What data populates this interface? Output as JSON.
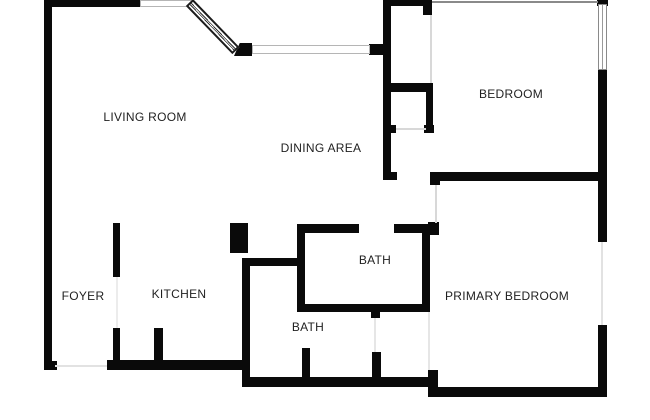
{
  "plan": {
    "width": 650,
    "height": 420,
    "background_color": "#ffffff",
    "wall_color": "#0a0a0a",
    "faint_line_color": "#d8d8d8",
    "window_line_color": "#8a8a8a",
    "label_color": "#1f1f1f"
  },
  "rooms": [
    {
      "id": "living-room",
      "label": "LIVING ROOM",
      "cx": 145,
      "cy": 117
    },
    {
      "id": "dining-area",
      "label": "DINING AREA",
      "cx": 321,
      "cy": 148
    },
    {
      "id": "bedroom",
      "label": "BEDROOM",
      "cx": 511,
      "cy": 94
    },
    {
      "id": "foyer",
      "label": "FOYER",
      "cx": 83,
      "cy": 296
    },
    {
      "id": "kitchen",
      "label": "KITCHEN",
      "cx": 179,
      "cy": 294
    },
    {
      "id": "bath-upper",
      "label": "BATH",
      "cx": 375,
      "cy": 260
    },
    {
      "id": "bath-lower",
      "label": "BATH",
      "cx": 308,
      "cy": 327
    },
    {
      "id": "primary-bedroom",
      "label": "PRIMARY BEDROOM",
      "cx": 507,
      "cy": 296
    }
  ],
  "walls": [
    {
      "name": "left-wall",
      "x": 44,
      "y": 0,
      "w": 8,
      "h": 370
    },
    {
      "name": "left-wall-foot",
      "x": 52,
      "y": 361,
      "w": 5,
      "h": 9
    },
    {
      "name": "top-wall-living",
      "x": 44,
      "y": 0,
      "w": 97,
      "h": 7
    },
    {
      "name": "window-corner-cap",
      "x": 234,
      "y": 43,
      "w": 18,
      "h": 13,
      "clip": "polygon(0 100%, 32% 0, 100% 0, 100% 100%)"
    },
    {
      "name": "window-right-stub",
      "x": 369,
      "y": 44,
      "w": 20,
      "h": 11
    },
    {
      "name": "dining-right-wall",
      "x": 383,
      "y": 0,
      "w": 8,
      "h": 180
    },
    {
      "name": "dining-wall-foot",
      "x": 391,
      "y": 172,
      "w": 6,
      "h": 8
    },
    {
      "name": "bedroom-top-wall",
      "x": 383,
      "y": 0,
      "w": 41,
      "h": 6
    },
    {
      "name": "bedroom-door-jamb",
      "x": 423,
      "y": 0,
      "w": 9,
      "h": 15
    },
    {
      "name": "closet-top-wall",
      "x": 385,
      "y": 83,
      "w": 48,
      "h": 9
    },
    {
      "name": "closet-right-wall",
      "x": 426,
      "y": 83,
      "w": 7,
      "h": 50
    },
    {
      "name": "closet-right-cap",
      "x": 424,
      "y": 125,
      "w": 10,
      "h": 8
    },
    {
      "name": "closet-left-stub",
      "x": 383,
      "y": 125,
      "w": 13,
      "h": 8
    },
    {
      "name": "bedroom-window-cap",
      "x": 597,
      "y": 0,
      "w": 11,
      "h": 6
    },
    {
      "name": "right-wall-upper",
      "x": 598,
      "y": 69,
      "w": 9,
      "h": 173
    },
    {
      "name": "right-wall-lower",
      "x": 598,
      "y": 325,
      "w": 9,
      "h": 72
    },
    {
      "name": "bedroom-bottom-wall",
      "x": 430,
      "y": 172,
      "w": 177,
      "h": 9
    },
    {
      "name": "bedroom-bottom-wall-cap",
      "x": 430,
      "y": 172,
      "w": 10,
      "h": 13
    },
    {
      "name": "bath-top-wall-left",
      "x": 297,
      "y": 224,
      "w": 62,
      "h": 9
    },
    {
      "name": "bath-top-wall-right",
      "x": 394,
      "y": 224,
      "w": 36,
      "h": 9
    },
    {
      "name": "bath-door-jamb",
      "x": 428,
      "y": 222,
      "w": 11,
      "h": 13
    },
    {
      "name": "bath-left-wall",
      "x": 297,
      "y": 224,
      "w": 8,
      "h": 88
    },
    {
      "name": "bath-right-wall",
      "x": 422,
      "y": 224,
      "w": 8,
      "h": 88
    },
    {
      "name": "bath-bottom-wall",
      "x": 297,
      "y": 304,
      "w": 133,
      "h": 8
    },
    {
      "name": "bath-bottom-stub",
      "x": 371,
      "y": 312,
      "w": 9,
      "h": 6
    },
    {
      "name": "kitchen-column",
      "x": 230,
      "y": 223,
      "w": 18,
      "h": 30
    },
    {
      "name": "kitchen-hall-wall",
      "x": 245,
      "y": 258,
      "w": 60,
      "h": 8
    },
    {
      "name": "kitchen-right-wall",
      "x": 242,
      "y": 258,
      "w": 8,
      "h": 129
    },
    {
      "name": "foyer-kitchen-wall-upper",
      "x": 113,
      "y": 223,
      "w": 7,
      "h": 54
    },
    {
      "name": "foyer-kitchen-wall-lower",
      "x": 113,
      "y": 328,
      "w": 7,
      "h": 38
    },
    {
      "name": "bottom-wall-kitchen",
      "x": 107,
      "y": 360,
      "w": 143,
      "h": 10
    },
    {
      "name": "kitchen-stub",
      "x": 154,
      "y": 328,
      "w": 9,
      "h": 38
    },
    {
      "name": "bottom-wall-bath",
      "x": 242,
      "y": 377,
      "w": 190,
      "h": 10
    },
    {
      "name": "bottom-step-connector",
      "x": 428,
      "y": 370,
      "w": 10,
      "h": 27
    },
    {
      "name": "bottom-wall-primary",
      "x": 430,
      "y": 387,
      "w": 177,
      "h": 10
    },
    {
      "name": "lower-bath-stub-left",
      "x": 302,
      "y": 348,
      "w": 8,
      "h": 29
    },
    {
      "name": "lower-bath-stub-right",
      "x": 372,
      "y": 352,
      "w": 9,
      "h": 25
    }
  ],
  "windows": [
    {
      "name": "window-living-top",
      "x": 140,
      "y": 0,
      "w": 53,
      "h": 7,
      "orient": "h"
    },
    {
      "name": "window-living-front",
      "x": 252,
      "y": 45,
      "w": 118,
      "h": 9,
      "orient": "h"
    },
    {
      "name": "window-bedroom-right",
      "x": 598,
      "y": 4,
      "w": 9,
      "h": 66,
      "orient": "v"
    }
  ],
  "diagonal_window": {
    "name": "window-living-corner",
    "x": 193,
    "y": -1,
    "length": 67,
    "thickness": 10,
    "angle": 46
  },
  "faint_lines": [
    {
      "name": "bedroom-top-edge-line",
      "x": 432,
      "y": 1,
      "w": 166,
      "h": 2,
      "color": "#8a8a8a"
    },
    {
      "name": "bedroom-door-leaf",
      "x": 430,
      "y": 15,
      "w": 2,
      "h": 68
    },
    {
      "name": "closet-opening-line",
      "x": 396,
      "y": 128,
      "w": 30,
      "h": 2
    },
    {
      "name": "primary-door-leaf",
      "x": 435,
      "y": 185,
      "w": 2,
      "h": 38
    },
    {
      "name": "primary-window-line",
      "x": 601,
      "y": 242,
      "w": 2,
      "h": 83,
      "color": "#e2e2e2"
    },
    {
      "name": "foyer-door-opening-line",
      "x": 116,
      "y": 277,
      "w": 2,
      "h": 51,
      "color": "#ececec"
    },
    {
      "name": "entry-threshold-line",
      "x": 55,
      "y": 365,
      "w": 52,
      "h": 2,
      "color": "#e2e2e2"
    },
    {
      "name": "bath-lower-door-leaf",
      "x": 374,
      "y": 318,
      "w": 2,
      "h": 34,
      "color": "#e6e6e6"
    },
    {
      "name": "primary-closet-line",
      "x": 428,
      "y": 312,
      "w": 2,
      "h": 58,
      "color": "#e6e6e6"
    }
  ]
}
